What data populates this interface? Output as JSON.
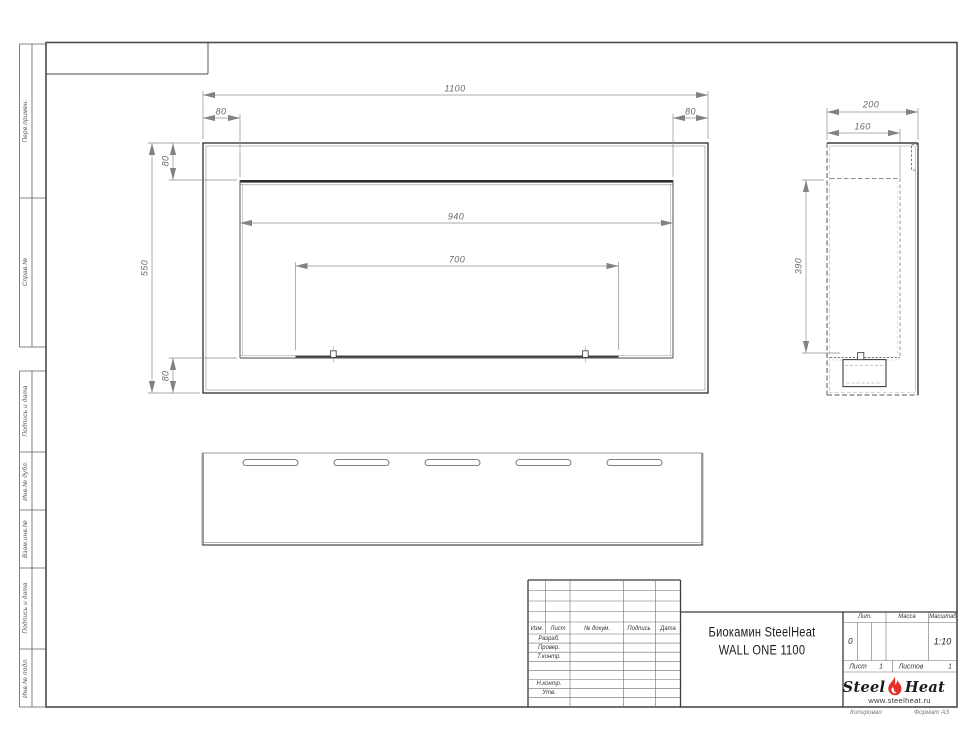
{
  "colors": {
    "flame": "#e2322a",
    "line": "#3d3d3d",
    "dim_text": "#6b6b6b"
  },
  "left_strip": {
    "items": [
      "Перв.примен.",
      "Справ.№",
      "Подпись и дата",
      "Инв.№ дубл.",
      "Взам.инв.№",
      "Подпись и дата",
      "Инв.№ подл."
    ]
  },
  "dimensions": {
    "front": {
      "overall_width": "1100",
      "left_offset": "80",
      "right_offset": "80",
      "top_offset": "80",
      "height": "550",
      "opening_width": "940",
      "burner_width": "700",
      "bottom_offset": "80"
    },
    "side": {
      "depth": "200",
      "inner_depth": "160",
      "opening_height": "390"
    }
  },
  "title_block": {
    "revision_columns": {
      "izm": "Изм.",
      "list": "Лист",
      "doc": "№ докум.",
      "podpis": "Подпись",
      "data": "Дата"
    },
    "signature_rows": {
      "razrab": "Разраб.",
      "prover": "Провер.",
      "tkontr": "Т.контр.",
      "nkontr": "Н.контр.",
      "utv": "Утв."
    },
    "title": {
      "line1": "Биокамин SteelHeat",
      "line2": "WALL ONE 1100"
    },
    "lit_label": "Лит.",
    "massa_label": "Масса",
    "masshtab_label": "Масштаб",
    "lit_value": "0",
    "masshtab_value": "1:10",
    "list_label": "Лист",
    "list_value": "1",
    "listov_label": "Листов",
    "listov_value": "1",
    "logo": {
      "word1": "Steel",
      "word2": "Heat",
      "url": "www.steelheat.ru"
    }
  },
  "footer": {
    "kopiroval": "Копировал",
    "format": "Формат А3"
  }
}
